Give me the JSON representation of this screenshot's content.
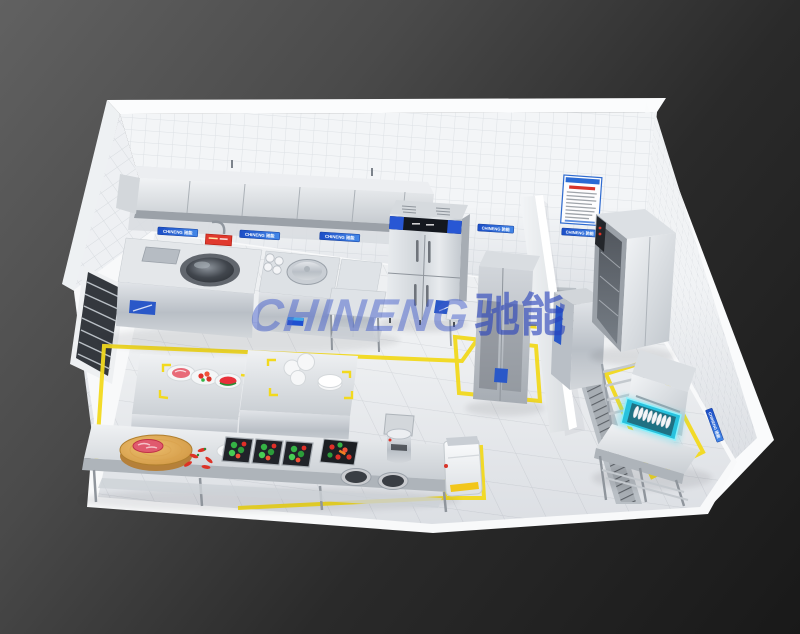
{
  "scene": {
    "description": "3D isometric rendering of a commercial kitchen layout",
    "render_style": "cutaway tiled room on dark gradient background"
  },
  "branding": {
    "watermark_latin": "CHINENG",
    "watermark_cjk": "驰能",
    "banner_text": "CHINENG 驰能",
    "accent_blue": "#1d50c8",
    "watermark_blue": "rgba(47,84,194,0.55)"
  },
  "palette": {
    "background_top": "#616161",
    "background_bottom": "#191919",
    "wall_tile": "#f3f5f7",
    "tile_line": "#dde1e5",
    "floor": "#eef0f2",
    "stainless": "#c9ced3",
    "floor_marking_yellow": "#f2d91e",
    "dish_rack_cyan": "#2cc4e0",
    "food_red": "#e03028",
    "food_green": "#35b345",
    "wood": "#cf9440"
  },
  "room": {
    "walls": "white-tile-walls",
    "floor": "marble-tile-floor",
    "features": [
      "louver-window-left-wall",
      "hygiene-poster-back-wall",
      "partition-wall",
      "floor-drain-trench",
      "yellow-floor-markings"
    ]
  },
  "equipment": {
    "cooking_line": [
      "exhaust-hood",
      "wok-range",
      "pot-filler-pipe",
      "steam-cup-rack",
      "stockpot-cooker",
      "cooking-cabinet"
    ],
    "back_wall": [
      "backsplash-panel",
      "prep-table",
      "four-door-refrigerator",
      "tall-storage-cabinet",
      "side-table"
    ],
    "washing_area": [
      "disinfection-cabinet",
      "storage-cabinet",
      "rack-trolley",
      "hood-dishwasher",
      "dish-rack-with-plates",
      "clean-dish-table",
      "floor-drain-trench"
    ],
    "center_tables": [
      "food-display-table",
      "plate-table"
    ],
    "prep_line": [
      "long-prep-table",
      "cutting-board",
      "meat",
      "plate",
      "chili-peppers",
      "vegetable-sinks",
      "vegetable-tray",
      "soup-pots",
      "rice-washer",
      "flour-machine"
    ]
  }
}
